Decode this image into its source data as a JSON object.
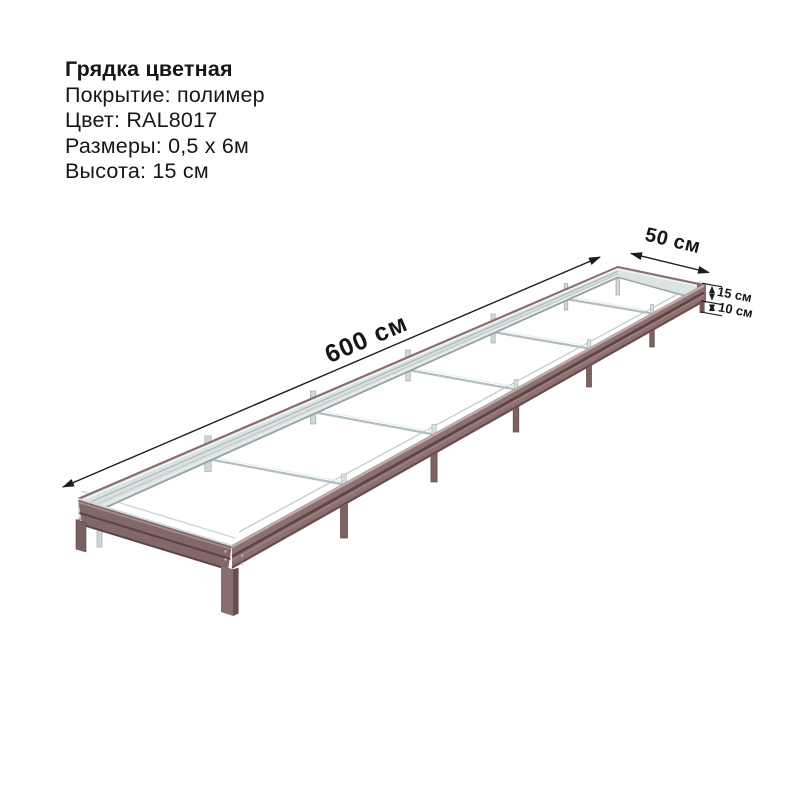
{
  "product": {
    "title": "Грядка цветная",
    "specs": [
      "Покрытие: полимер",
      "Цвет: RAL8017",
      "Размеры: 0,5 х 6м",
      "Высота: 15 см"
    ]
  },
  "diagram": {
    "length_label": "600 см",
    "width_label": "50 см",
    "height_label": "15 см",
    "leg_label": "10 см",
    "colors": {
      "frame_brown": "#8d7070",
      "frame_groove": "#5d4444",
      "galvanized": "#d9e1e1",
      "dimension_lines": "#1c1c1c"
    }
  }
}
